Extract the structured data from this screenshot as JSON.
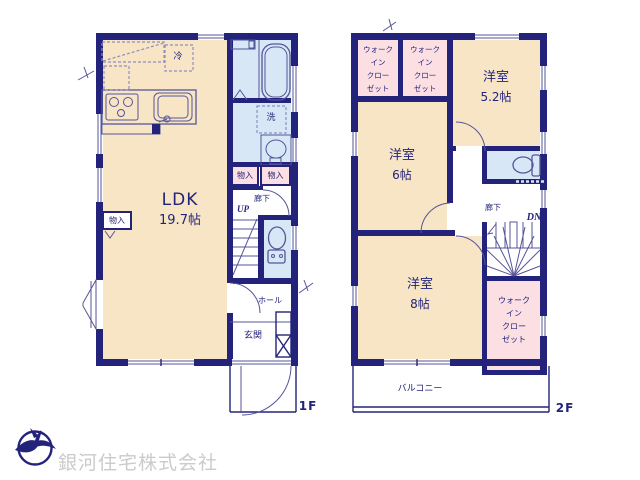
{
  "colors": {
    "wall_navy": "#23237b",
    "room_cream": "#f7e5c5",
    "closet_pink": "#fbdfe3",
    "wet_area_blue": "#d8e7f5",
    "company_gray": "#cbcbcb"
  },
  "floor1": {
    "label": "1F",
    "ldk_name": "LDK",
    "ldk_size": "19.7帖",
    "fridge_label": "冷",
    "washer_label": "洗",
    "storage_left": "物入",
    "storage_a": "物入",
    "storage_b": "物入",
    "corridor": "廊下",
    "stairs": "UP",
    "hall": "ホール",
    "entrance": "玄関"
  },
  "floor2": {
    "label": "2F",
    "room_52_name": "洋室",
    "room_52_size": "5.2帖",
    "room_6_name": "洋室",
    "room_6_size": "6帖",
    "room_8_name": "洋室",
    "room_8_size": "8帖",
    "corridor": "廊下",
    "stairs": "DN",
    "balcony": "バルコニー",
    "wic_lines": [
      "ウォーク",
      "イン",
      "クロー",
      "ゼット"
    ]
  },
  "footer": {
    "company_name": "銀河住宅株式会社",
    "logo": "bird-circle-logo"
  }
}
